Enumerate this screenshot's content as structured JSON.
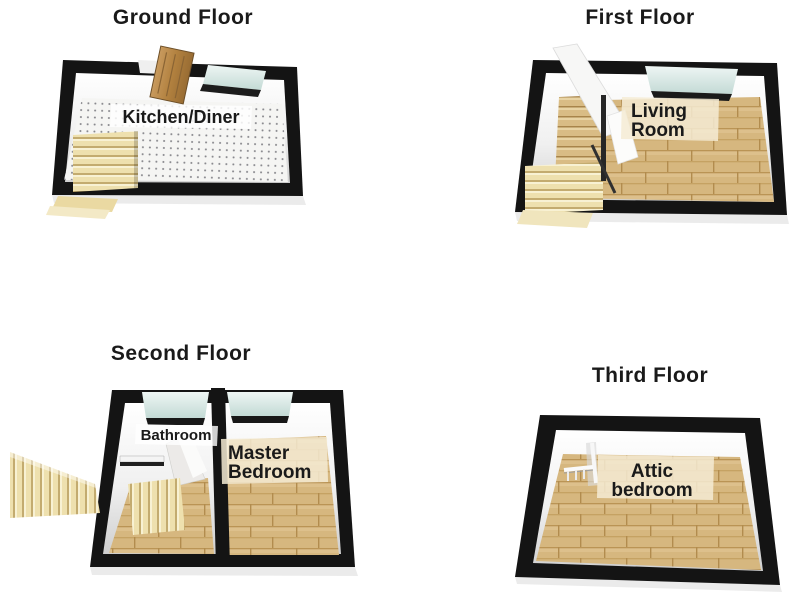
{
  "palette": {
    "background": "#ffffff",
    "wall": "#141414",
    "inner_wall": "#f1f1f1",
    "tile_floor": "#f5f5f3",
    "wood_floor": "#d6b77f",
    "stairs": "#ead9a2",
    "window_glass": "#cfe3de",
    "door_wood": "#b2813f",
    "label_text": "#1a1a1a"
  },
  "plans": {
    "ground": {
      "title": "Ground Floor",
      "room_label": "Kitchen/Diner"
    },
    "first": {
      "title": "First Floor",
      "room_label": "Living Room",
      "room_label_lines": [
        "Living",
        "Room"
      ]
    },
    "second": {
      "title": "Second Floor",
      "bathroom_label": "Bathroom",
      "bedroom_label": "Master Bedroom",
      "bedroom_label_lines": [
        "Master",
        "Bedroom"
      ]
    },
    "third": {
      "title": "Third Floor",
      "room_label": "Attic bedroom",
      "room_label_lines": [
        "Attic",
        "bedroom"
      ]
    }
  }
}
